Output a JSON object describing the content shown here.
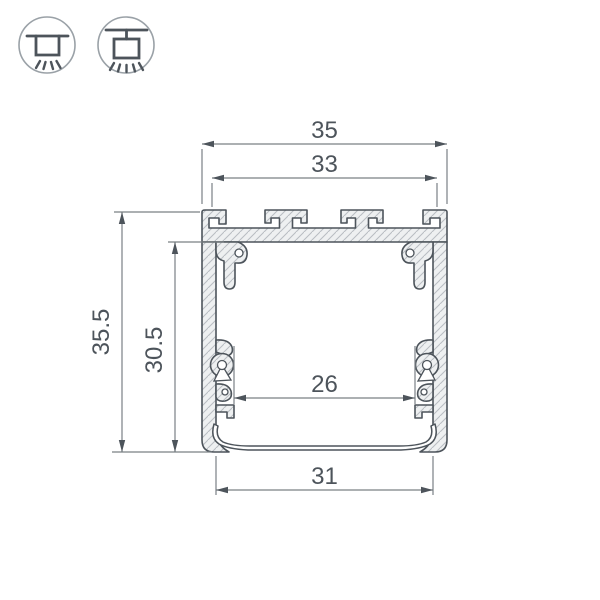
{
  "meta": {
    "type": "technical-drawing",
    "subject": "aluminium-led-profile-cross-section"
  },
  "mount_icons": [
    {
      "name": "surface-ceiling-mount"
    },
    {
      "name": "pendant-suspension-mount"
    }
  ],
  "dimensions": {
    "outer_width": "35",
    "top_slot_width": "33",
    "outer_height": "35.5",
    "inner_height": "30.5",
    "inner_width": "26",
    "bottom_width": "31"
  },
  "colors": {
    "outline": "#4d545b",
    "metal_fill": "#eef0f1",
    "hatch_line": "#b9bdc2",
    "dimension_line": "#7a8085",
    "dimension_text": "#4d545b",
    "icon_circle": "#9aa1a7",
    "background": "#ffffff"
  }
}
